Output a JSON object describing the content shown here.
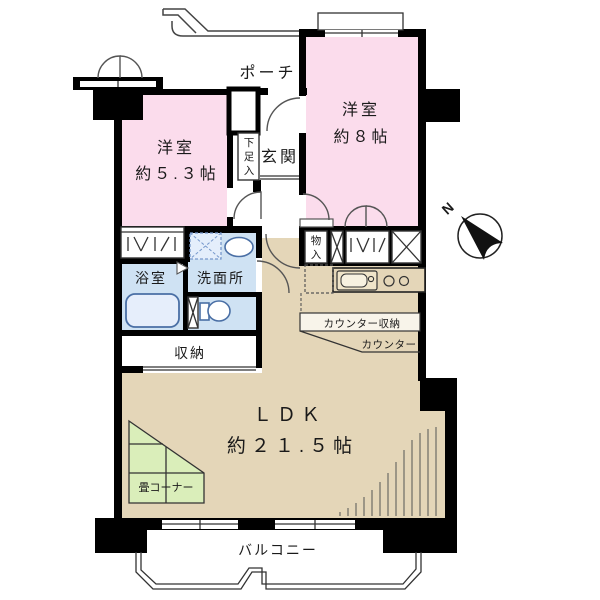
{
  "colors": {
    "room_pink": "#fbdcec",
    "ldk_tan": "#e4d6b8",
    "wet_blue": "#cfe2f3",
    "tatami_green": "#daeeba",
    "counter_cream": "#f8f4ea",
    "wall_black": "#000000",
    "fixture_blue": "#4a6fa5"
  },
  "rooms": {
    "western8": {
      "name": "洋室",
      "size": "約８帖"
    },
    "western53": {
      "name": "洋室",
      "size": "約５.３帖"
    },
    "ldk": {
      "name": "ＬＤＫ",
      "size": "約２１.５帖"
    },
    "bath": {
      "name": "浴室"
    },
    "washroom": {
      "name": "洗面所"
    },
    "storage": {
      "name": "収納"
    },
    "tatami_corner": {
      "name": "畳コーナー"
    },
    "balcony": {
      "name": "バルコニー"
    },
    "porch": {
      "name": "ポーチ"
    },
    "entrance": {
      "name": "玄関"
    }
  },
  "labels": {
    "shoe_cabinet": [
      "下",
      "足",
      "入"
    ],
    "closet_small": [
      "物",
      "入"
    ],
    "counter_storage": "カウンター収納",
    "counter": "カウンター",
    "compass_north": "N"
  }
}
